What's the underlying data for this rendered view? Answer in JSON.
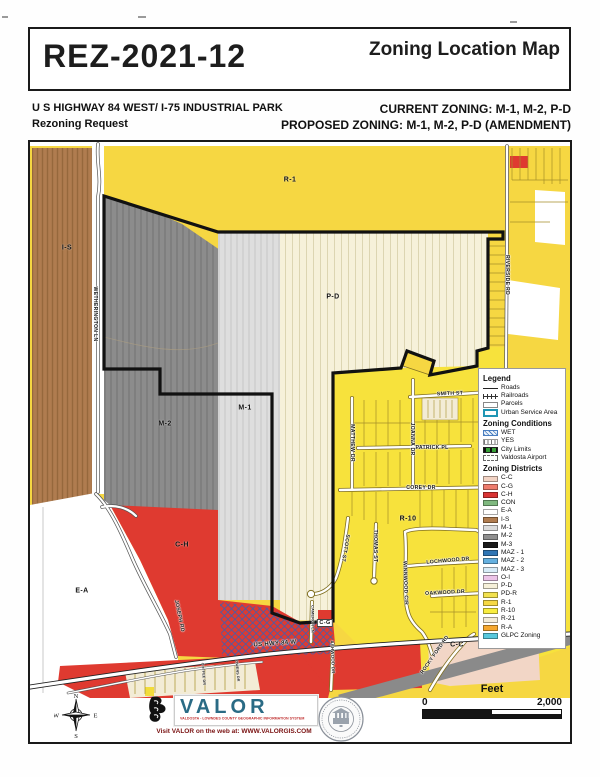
{
  "header": {
    "case_number": "REZ-2021-12",
    "map_title": "Zoning Location Map"
  },
  "subheader": {
    "line1": "U S HIGHWAY 84 WEST/ I-75 INDUSTRIAL PARK",
    "line2": "Rezoning Request",
    "current_zoning": "CURRENT ZONING: M-1, M-2, P-D",
    "proposed_zoning": "PROPOSED ZONING: M-1, M-2, P-D (AMENDMENT)"
  },
  "colors": {
    "r1_yellow": "#F6D742",
    "neighborhood_yellow": "#F7E23C",
    "is_brown": "#B07C4F",
    "m1_gray": "#DEDEDE",
    "m2_gray": "#8C8C8C",
    "pd_cream": "#F6F1DA",
    "ch_red": "#DF3A30",
    "cc_pink": "#F2D6C6",
    "r21_cream": "#F3ECD6",
    "boundary": "#111111"
  },
  "map": {
    "zone_labels": [
      {
        "t": "R-1",
        "x": 260,
        "y": 38
      },
      {
        "t": "I-S",
        "x": 37,
        "y": 106
      },
      {
        "t": "P-D",
        "x": 303,
        "y": 155
      },
      {
        "t": "M-1",
        "x": 215,
        "y": 266
      },
      {
        "t": "M-2",
        "x": 135,
        "y": 282
      },
      {
        "t": "R-10",
        "x": 378,
        "y": 377
      },
      {
        "t": "E-A",
        "x": 52,
        "y": 449
      },
      {
        "t": "C-H",
        "x": 152,
        "y": 403
      },
      {
        "t": "C-C",
        "x": 427,
        "y": 503
      },
      {
        "t": "C-G",
        "x": 295,
        "y": 481,
        "chip": true
      }
    ],
    "street_labels": [
      {
        "t": "WETHERINGTON LN",
        "x": 65,
        "y": 172,
        "r": 90,
        "s": 5.2
      },
      {
        "t": "RIVERSIDE RD",
        "x": 477,
        "y": 133,
        "r": 90,
        "s": 5.2
      },
      {
        "t": "SMITH ST",
        "x": 420,
        "y": 252,
        "r": -2,
        "s": 5.2
      },
      {
        "t": "JOANNA DR",
        "x": 382,
        "y": 297,
        "r": 90,
        "s": 5.2
      },
      {
        "t": "MATTHEW DR",
        "x": 322,
        "y": 301,
        "r": 90,
        "s": 5.2
      },
      {
        "t": "PATRICK PL",
        "x": 402,
        "y": 306,
        "r": 0,
        "s": 5.2
      },
      {
        "t": "COREY DR",
        "x": 391,
        "y": 346,
        "r": 0,
        "s": 5.2
      },
      {
        "t": "SCOTT ST",
        "x": 315,
        "y": 406,
        "r": 100,
        "s": 5.2
      },
      {
        "t": "THOMAS ST",
        "x": 345,
        "y": 404,
        "r": 90,
        "s": 5.2
      },
      {
        "t": "WINNWOOD CIR",
        "x": 375,
        "y": 441,
        "r": 88,
        "s": 5.2
      },
      {
        "t": "LOCHWOOD DR",
        "x": 418,
        "y": 419,
        "r": -5,
        "s": 5.2
      },
      {
        "t": "OAKWOOD DR",
        "x": 415,
        "y": 451,
        "r": -3,
        "s": 5.2
      },
      {
        "t": "JOSEPH RD",
        "x": 149,
        "y": 474,
        "r": 78,
        "s": 5.2
      },
      {
        "t": "US HWY 84 W",
        "x": 245,
        "y": 502,
        "r": -4,
        "s": 6
      },
      {
        "t": "CAMERON LN",
        "x": 282,
        "y": 477,
        "r": 90,
        "s": 3.8
      },
      {
        "t": "ASHWOOD DR",
        "x": 302,
        "y": 515,
        "r": 88,
        "s": 4.4
      },
      {
        "t": "ROCKY FORD RD",
        "x": 405,
        "y": 513,
        "r": -55,
        "s": 5
      },
      {
        "t": "COFFEE DR",
        "x": 173,
        "y": 532,
        "r": 85,
        "s": 3.6
      },
      {
        "t": "OWENS DR",
        "x": 207,
        "y": 529,
        "r": 85,
        "s": 3.6
      }
    ]
  },
  "legend": {
    "title": "Legend",
    "general_items": [
      {
        "label": "Roads",
        "symbol": "road"
      },
      {
        "label": "Railroads",
        "symbol": "rail"
      },
      {
        "label": "Parcels",
        "symbol": "parcel"
      },
      {
        "label": "Urban Service Area",
        "symbol": "usa"
      }
    ],
    "conditions_title": "Zoning Conditions",
    "condition_items": [
      {
        "label": "WET",
        "symbol": "wet"
      },
      {
        "label": "YES",
        "symbol": "yes"
      },
      {
        "label": "City Limits",
        "symbol": "city"
      },
      {
        "label": "Valdosta Airport",
        "symbol": "air"
      }
    ],
    "districts_title": "Zoning Districts",
    "districts": [
      {
        "code": "C-C",
        "color": "#F2D3C4"
      },
      {
        "code": "C-G",
        "color": "#EE7B6C"
      },
      {
        "code": "C-H",
        "color": "#D93434"
      },
      {
        "code": "CON",
        "color": "#7FB97F"
      },
      {
        "code": "E-A",
        "color": "#FFFFFF"
      },
      {
        "code": "I-S",
        "color": "#B07C4F"
      },
      {
        "code": "M-1",
        "color": "#DCDCDC"
      },
      {
        "code": "M-2",
        "color": "#8F8F8F"
      },
      {
        "code": "M-3",
        "color": "#1A1A1A"
      },
      {
        "code": "MAZ - 1",
        "color": "#2E75B5"
      },
      {
        "code": "MAZ - 2",
        "color": "#64B0E0"
      },
      {
        "code": "MAZ - 3",
        "color": "#D8ECF8"
      },
      {
        "code": "O-I",
        "color": "#ECC4E8"
      },
      {
        "code": "P-D",
        "color": "#F6F1DA",
        "pattern": "diag"
      },
      {
        "code": "PD-R",
        "color": "#F2E14E",
        "pattern": "diag"
      },
      {
        "code": "R-1",
        "color": "#F6D842"
      },
      {
        "code": "R-10",
        "color": "#F9ED3E"
      },
      {
        "code": "R-21",
        "color": "#F4ECD8"
      },
      {
        "code": "R-A",
        "color": "#F5A72E"
      },
      {
        "code": "GLPC Zoning",
        "color": "#58C8DC",
        "pattern": "diagw"
      }
    ]
  },
  "footer": {
    "compass": {
      "n": "N",
      "s": "S",
      "e": "E",
      "w": "W"
    },
    "valor": {
      "name": "VALOR",
      "tagline": "VALDOSTA - LOWNDES COUNTY GEOGRAPHIC INFORMATION SYSTEM",
      "web": "Visit VALOR on the web at: WWW.VALORGIS.COM"
    },
    "scale": {
      "label": "Feet",
      "min": "0",
      "max": "2,000"
    }
  }
}
